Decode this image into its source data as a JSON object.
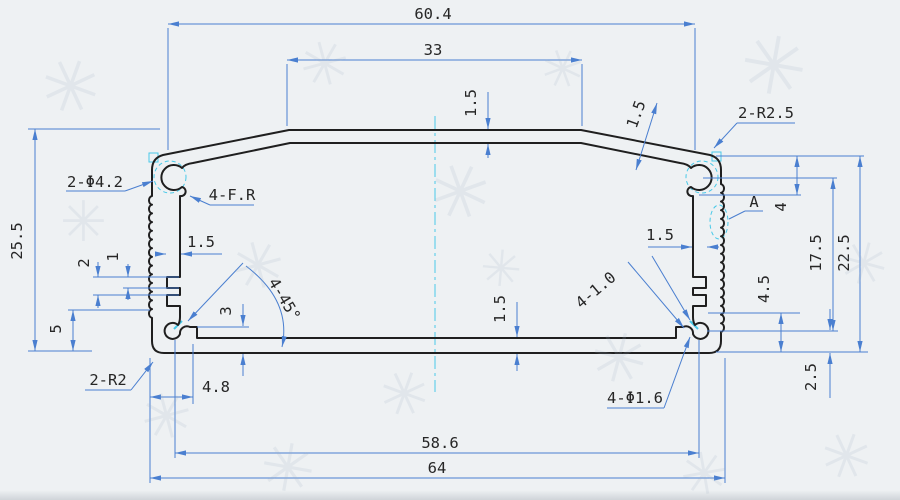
{
  "colors": {
    "dimension": "#4a7fd0",
    "profile": "#1f1f1f",
    "centerline": "#49c9e8",
    "text": "#262626",
    "paper": "#eef1f3"
  },
  "drawing": {
    "type": "aluminum-extrusion-enclosure-profile-cross-section",
    "dims": {
      "top_width": "60.4",
      "plateau_width": "33",
      "plateau_wall": "1.5",
      "slope_wall": "1.5",
      "corner_radius_top": "2-R2.5",
      "screw_hole": "2-Φ4.2",
      "full_radius": "4-F.R",
      "detail": "A",
      "step_right": "4",
      "inner_height": "17.5",
      "outer_height": "22.5",
      "lower_right": "4.5",
      "hole_offset": "2.5",
      "total_height": "25.5",
      "notch_pitch": "2",
      "notch_width": "1",
      "wall_left": "1.5",
      "wall_right": "1.5",
      "boss_zone": "5",
      "ledge": "3",
      "chamfer": "4-45°",
      "corner_radius_bottom": "2-R2",
      "foot": "4.8",
      "floor_wall": "1.5",
      "slot_width": "4-1.0",
      "pin_hole": "4-Φ1.6",
      "hole_span": "58.6",
      "total_width": "64"
    }
  }
}
